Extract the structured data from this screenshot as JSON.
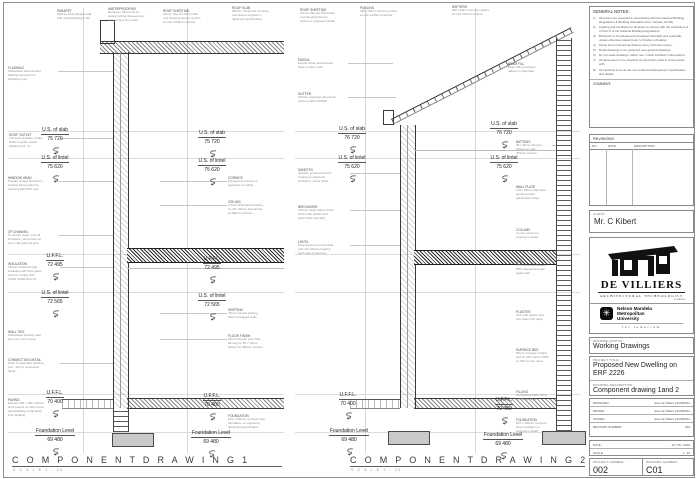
{
  "footer": {
    "drawing1_title": "C O M P O N E N T   D R A W I N G 1",
    "drawing1_scale": "S C A L E   1 : 20",
    "drawing2_title": "C O M P O N E N T   D R A W I N G  2",
    "drawing2_scale": "S C A L E   1 : 20"
  },
  "general_notes": {
    "title": "GENERAL NOTES:",
    "items": [
      {
        "n": "1)",
        "text": "All work to be executed in accordance with the National Building Regulations & Building Standards (Gov. Gazette 12130)."
      },
      {
        "n": "2)",
        "text": "Lighting and ventilation to all areas to comply with the schedule A-3 of Part O of the National Building Regulations."
      },
      {
        "n": "3)",
        "text": "Brickwork to be plastered and painted internally and externally unless otherwise stated (refer to finishes schedule)."
      },
      {
        "n": "4)",
        "text": "Damp proof course/membranes every 3rd brick course."
      },
      {
        "n": "5)",
        "text": "Detail drawings to be preferred over general drawings."
      },
      {
        "n": "6)",
        "text": "Do not scale drawings; rather use / check Architect's dimensions."
      },
      {
        "n": "7)",
        "text": "All dimensions to be checked on site before work is commenced with."
      },
      {
        "n": "8)",
        "text": "All electrical to be as set out on Electrical Engineer's specification and details."
      }
    ],
    "comment_label": "COMMENT:"
  },
  "revisions": {
    "title": "REVISIONS:",
    "columns": [
      "NO.",
      "DATE",
      "DESCRIPTION"
    ]
  },
  "client": {
    "label": "CLIENT :",
    "name": "Mr. C Kibert"
  },
  "firm": {
    "name": "DE VILLIERS",
    "subtitle": "ARCHITECTURAL TECHNOLOGIST",
    "tag": "in training"
  },
  "university": {
    "line1": "Nelson Mandela",
    "line2": "Metropolitan",
    "line3": "University",
    "tagline": "for tomorrow",
    "icon": "✳"
  },
  "title_block": {
    "status_label": "DRAWING STATUS :",
    "status": "Working Drawings",
    "project_label": "PROJECT TITLE :",
    "project": "Proposed New Dwelling on ERF 2226",
    "description_label": "DRAWING DESCRIPTION :",
    "description": "Component drawing 1and 2",
    "rows": [
      {
        "label": "DESIGNED :",
        "value": "Juan de Villiers   21/08/2012"
      },
      {
        "label": "DRAWN :",
        "value": "Juan de Villiers   21/08/2012"
      },
      {
        "label": "ISSUED :",
        "value": "Juan de Villiers   21/08/2012"
      },
      {
        "label": "REVISION NUMBER :",
        "value": "002"
      }
    ],
    "date_label": "DATE :",
    "date": "10 / 05 / 2015",
    "scale_label": "SCALE :",
    "scale": "1 : 20",
    "project_number_label": "PROJECT NUMBER :",
    "project_number": "002",
    "drawing_number_label": "DRAWING NUMBER :",
    "drawing_number": "C01"
  },
  "markers": [
    {
      "label": "U.S. of slab",
      "value": "75 720",
      "x": 33,
      "y": 118
    },
    {
      "label": "U.S. of slab",
      "value": "75 720",
      "x": 190,
      "y": 121
    },
    {
      "label": "U.S. of lintel",
      "value": "75 620",
      "x": 33,
      "y": 146
    },
    {
      "label": "U.S. of lintel",
      "value": "75 620",
      "x": 190,
      "y": 149
    },
    {
      "label": "U.F.F.L.",
      "value": "72 495",
      "x": 33,
      "y": 244
    },
    {
      "label": "U.F.F.L.",
      "value": "72 495",
      "x": 190,
      "y": 247
    },
    {
      "label": "U.S. of lintel",
      "value": "72 565",
      "x": 33,
      "y": 281
    },
    {
      "label": "U.S. of lintel",
      "value": "72 565",
      "x": 190,
      "y": 284
    },
    {
      "label": "U.F.F.L.",
      "value": "70 400",
      "x": 33,
      "y": 381
    },
    {
      "label": "U.F.F.L.",
      "value": "70 400",
      "x": 190,
      "y": 384
    },
    {
      "label": "Foundation Level",
      "value": "69 480",
      "x": 30,
      "y": 419,
      "w": 50
    },
    {
      "label": "Foundation Level",
      "value": "69 480",
      "x": 186,
      "y": 421,
      "w": 50
    },
    {
      "label": "U.S. of slab",
      "value": "76 720",
      "x": 330,
      "y": 117
    },
    {
      "label": "U.S. of slab",
      "value": "76 720",
      "x": 482,
      "y": 112
    },
    {
      "label": "U.S. of lintel",
      "value": "75 620",
      "x": 330,
      "y": 146
    },
    {
      "label": "U.S. of lintel",
      "value": "75 620",
      "x": 482,
      "y": 146
    },
    {
      "label": "U.F.F.L.",
      "value": "70 400",
      "x": 326,
      "y": 383
    },
    {
      "label": "U.F.F.L.",
      "value": "70 400",
      "x": 482,
      "y": 388
    },
    {
      "label": "Foundation Level",
      "value": "69 480",
      "x": 324,
      "y": 419,
      "w": 50
    },
    {
      "label": "Foundation Level",
      "value": "69 480",
      "x": 478,
      "y": 423,
      "w": 50
    }
  ],
  "annotations": [
    {
      "x": 57,
      "y": 9,
      "w": 44,
      "header": "PARAPET",
      "lines": [
        "230mm brick parapet wall",
        "with metal flashing to fall"
      ]
    },
    {
      "x": 108,
      "y": 7,
      "w": 48,
      "header": "WATERPROOFING",
      "lines": [
        "Derbigum SP4 torch-on",
        "waterproofing dressed over",
        "parapet and into outlet"
      ]
    },
    {
      "x": 163,
      "y": 9,
      "w": 48,
      "header": "ROOF SHEETING",
      "lines": [
        "0.6mm Klip-lok 700 profile",
        "roof sheeting fixed to purlins",
        "at max 1700mm centres"
      ]
    },
    {
      "x": 232,
      "y": 6,
      "w": 46,
      "header": "ROOF SLAB",
      "lines": [
        "255mm reinforced concrete",
        "roof slab to engineer's",
        "detail and specification"
      ]
    },
    {
      "x": 300,
      "y": 8,
      "w": 48,
      "header": "ROOF SHEETING",
      "lines": [
        "0.6mm Klip-lok 700 profile",
        "roof sheeting fixed to",
        "purlins to engineer's detail"
      ]
    },
    {
      "x": 360,
      "y": 6,
      "w": 46,
      "header": "PURLINS",
      "lines": [
        "150 x 50mm SA pine purlins",
        "at max 1200mm centres"
      ]
    },
    {
      "x": 452,
      "y": 5,
      "w": 46,
      "header": "RAFTERS",
      "lines": [
        "228 x 50mm SA pine rafters",
        "at max 760mm centres"
      ]
    },
    {
      "x": 508,
      "y": 62,
      "w": 40,
      "header": "BEAM FILL",
      "lines": [
        "Beam filling between",
        "rafters on wall plate"
      ]
    },
    {
      "x": 8,
      "y": 66,
      "w": 50,
      "header": "FLASHING",
      "lines": [
        "Galvanised steel counter",
        "flashing dressed into",
        "brickwork joint"
      ]
    },
    {
      "x": 9,
      "y": 133,
      "w": 52,
      "header": "ROOF OUTLET",
      "lines": [
        "Full bore rainwater outlet.",
        "Refer to gutter layout",
        "drawing (A3 - 1)"
      ]
    },
    {
      "x": 8,
      "y": 176,
      "w": 50,
      "header": "WINDOW HEAD",
      "lines": [
        "Powder coated aluminium",
        "window frame built into",
        "opening with DPC over"
      ]
    },
    {
      "x": 8,
      "y": 230,
      "w": 50,
      "header": "CP CHANNEL",
      "lines": [
        "To ensure water runs off",
        "brickwork, weep holes at",
        "every 4th perpend joint"
      ]
    },
    {
      "x": 8,
      "y": 262,
      "w": 52,
      "header": "INSULATION",
      "lines": [
        "135mm Isoboard rigid",
        "insulation with fibre glass",
        "wrap to comply with",
        "SANS 10400 Part XA"
      ]
    },
    {
      "x": 8,
      "y": 330,
      "w": 50,
      "header": "WALL TIES",
      "lines": [
        "Galvanised butterfly wall",
        "ties every 3rd course"
      ]
    },
    {
      "x": 8,
      "y": 358,
      "w": 52,
      "header": "CONNECTION DETAIL",
      "lines": [
        "Refer to assembly drawing",
        "(A3 - 10) for connection",
        "detail"
      ]
    },
    {
      "x": 8,
      "y": 398,
      "w": 52,
      "header": "PAVING",
      "lines": [
        "Exterior 200 x 100 x 50mm",
        "brick pavers on 40mm river",
        "sand bedding to fall away",
        "from building"
      ]
    },
    {
      "x": 228,
      "y": 176,
      "w": 52,
      "header": "CORNICE",
      "lines": [
        "Polystyrene cornice to",
        "perimeter of ceiling"
      ]
    },
    {
      "x": 228,
      "y": 200,
      "w": 52,
      "header": "CEILING",
      "lines": [
        "6.4mm Rhinoboard ceiling",
        "on 38 x 38mm brandering",
        "at 400mm centres"
      ]
    },
    {
      "x": 228,
      "y": 308,
      "w": 50,
      "header": "SKIRTING",
      "lines": [
        "76mm meranti skirting",
        "fixed to plugged walls"
      ]
    },
    {
      "x": 228,
      "y": 334,
      "w": 52,
      "header": "FLOOR FINISH",
      "lines": [
        "22mm Oregon pine T&G",
        "flooring on 50 x 76mm",
        "battens at 450mm centres"
      ]
    },
    {
      "x": 228,
      "y": 414,
      "w": 52,
      "header": "FOUNDATION",
      "lines": [
        "615 x 230mm concrete strip",
        "foundation to engineer's",
        "detail and specification"
      ]
    },
    {
      "x": 298,
      "y": 58,
      "w": 48,
      "header": "FASCIA",
      "lines": [
        "Everite Nutec fascia board",
        "fixed to rafter ends"
      ]
    },
    {
      "x": 298,
      "y": 92,
      "w": 50,
      "header": "GUTTER",
      "lines": [
        "125mm seamless aluminium",
        "gutter to fall to RWDP"
      ]
    },
    {
      "x": 298,
      "y": 168,
      "w": 52,
      "header": "SANDTEX",
      "lines": [
        "Sandtex textured exterior",
        "coating on plastered",
        "brickwork, colour white"
      ]
    },
    {
      "x": 298,
      "y": 205,
      "w": 52,
      "header": "BRICKWORK",
      "lines": [
        "270mm cavity wall in stock",
        "bricks with plaster and",
        "paint finish internally"
      ]
    },
    {
      "x": 298,
      "y": 240,
      "w": 52,
      "header": "LINTEL",
      "lines": [
        "Prestressed concrete lintel",
        "with min 150mm bearing",
        "each side of opening"
      ]
    },
    {
      "x": 516,
      "y": 140,
      "w": 36,
      "header": "BATTENS",
      "lines": [
        "38 x 38mm SA pine",
        "battens at max",
        "470mm centres"
      ]
    },
    {
      "x": 516,
      "y": 185,
      "w": 36,
      "header": "WALL PLATE",
      "lines": [
        "114 x 38mm wall plate",
        "anchored with",
        "galvanised straps"
      ]
    },
    {
      "x": 516,
      "y": 228,
      "w": 36,
      "header": "COLUMN",
      "lines": [
        "Corner column to",
        "engineer's detail"
      ]
    },
    {
      "x": 516,
      "y": 260,
      "w": 36,
      "header": "DPC",
      "lines": [
        "375 micron embossed",
        "DPC stepped through",
        "cavity wall"
      ]
    },
    {
      "x": 516,
      "y": 310,
      "w": 36,
      "header": "PLASTER",
      "lines": [
        "One coat plaster and",
        "two coats PVA paint"
      ]
    },
    {
      "x": 516,
      "y": 348,
      "w": 36,
      "header": "SURFACE BED",
      "lines": [
        "85mm concrete surface",
        "bed on 250 micron DPM",
        "on 50mm river sand"
      ]
    },
    {
      "x": 516,
      "y": 390,
      "w": 36,
      "header": "FILLING",
      "lines": [
        "Compacted earth filling",
        "in 150mm layers"
      ]
    },
    {
      "x": 516,
      "y": 418,
      "w": 36,
      "header": "FOUNDATION",
      "lines": [
        "615 x 230mm concrete",
        "strip foundation to",
        "engineer's detail"
      ]
    }
  ]
}
